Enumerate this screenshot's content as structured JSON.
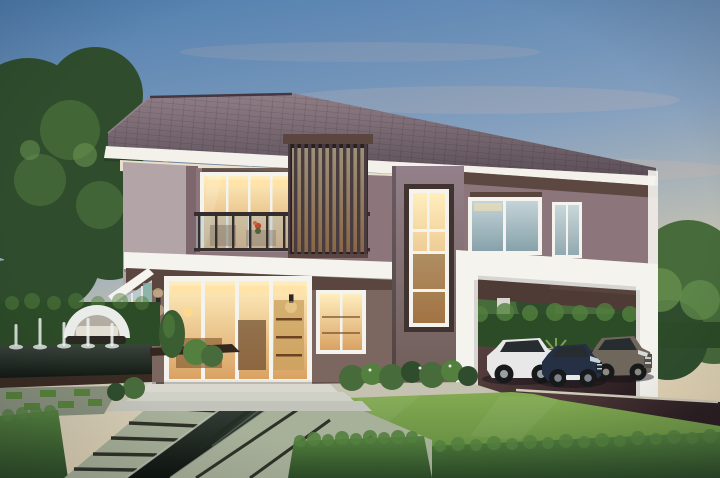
{
  "scene": {
    "description": "Photorealistic dusk rendering of a modern two-story house with a dark hipped tile roof, white fascia bands, warm-lit glass doors and windows, a balcony with glass railing and vertical slat screen, a tall stair window, a white portal-frame carport sheltering three cars, and a formal garden with lawn, trimmed hedges, stone slab walkways, reflecting pool channels, a fountain pool with water jets and a white cocoon daybed, framed by mature trees",
    "setting": {
      "time_of_day": "dusk",
      "sky": "clear blue fading to warm peach at the horizon"
    },
    "house": {
      "stories": 2,
      "roof": "hipped dark mauve tile",
      "features": [
        "white fascia with cream soffit and recessed downlights",
        "second-floor balcony with glass and steel railing",
        "vertical timber slat privacy screen with warm backlight",
        "double-height stair window with white grid frame",
        "warm-lit sliding glass doors on both floors",
        "glass sunroom corner with teal curtain",
        "up-down wall sconces",
        "white carport portal frame"
      ]
    },
    "vehicles": [
      {
        "type": "SUV",
        "color": "white"
      },
      {
        "type": "sedan",
        "color": "dark navy blue"
      },
      {
        "type": "SUV",
        "color": "brown-gray"
      }
    ],
    "garden": {
      "elements": [
        "manicured lawn",
        "trimmed hedge blocks and low hedge rows",
        "diagonal stone slab walkway with gravel seams",
        "dark reflecting pool channel",
        "fountain pool with five water jets",
        "white cocoon daybed",
        "grass-and-paver checker grid",
        "cone topiary and foundation shrubs",
        "dark timber deck edge",
        "mature background trees"
      ]
    }
  },
  "palette": {
    "sky_top": "#4e7dae",
    "sky_mid": "#85a0bf",
    "sky_low": "#c7c3b2",
    "sky_warm": "#e4d5b5",
    "cloud": "#cdb6ad",
    "roof_light": "#907e86",
    "roof_dark": "#5c4f58",
    "fascia": "#f3f1ea",
    "soffit": "#e9dfcc",
    "downlight": "#ffd894",
    "wall_upper": "#8c757b",
    "wall_lower": "#7b6660",
    "wall_side": "#b2a4a7",
    "pillar": "#7e676c",
    "tower_hi": "#93808a",
    "tower_lo": "#6d5b55",
    "trim_dark": "#5a463e",
    "carport_wall": "#4e3b35",
    "slat": "#493c40",
    "white_struct": "#f5f3ee",
    "glass_warm_hi": "#ffeebe",
    "glass_warm_lo": "#d9a263",
    "cove": "#ffe3a6",
    "glass_cool_hi": "#c4d4d7",
    "glass_cool_lo": "#87a1aa",
    "interior_dark": "#6b4a2e",
    "interior_wood": "#caa05e",
    "railing": "#352e2f",
    "railing_glass": "#a8bcc2",
    "tree_dark": "#2f4d2d",
    "tree_mid": "#476b3a",
    "tree_light": "#699350",
    "hedge_hi": "#53803e",
    "hedge_lo": "#2c4b27",
    "lawn_hi": "#84ab52",
    "lawn_lo": "#57813a",
    "paver_hi": "#a7b099",
    "paver_lo": "#878f7c",
    "seam": "#2e3127",
    "terrace": "#c6c2b2",
    "step": "#d8d8ce",
    "deck": "#3a2b23",
    "water_hi": "#3a453c",
    "water_lo": "#0d130e",
    "drive_hi": "#5a4241",
    "drive_lo": "#2b1e21",
    "car_white": "#e7e8e7",
    "car_navy": "#253044",
    "car_brown": "#6f665c",
    "car_glass": "#272c31",
    "wheel": "#17191b",
    "chrome": "#c8cccb",
    "daybed": "#eaece9",
    "daybed_shade": "#b3aca2",
    "jet": "#eef3f1"
  }
}
